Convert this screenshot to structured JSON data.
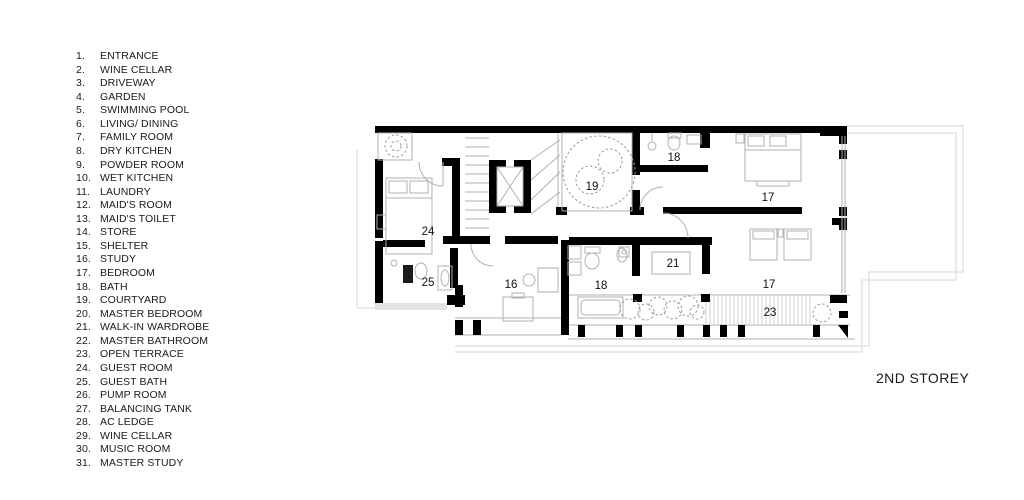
{
  "legend": {
    "items": [
      {
        "num": "1.",
        "label": "ENTRANCE"
      },
      {
        "num": "2.",
        "label": "WINE CELLAR"
      },
      {
        "num": "3.",
        "label": "DRIVEWAY"
      },
      {
        "num": "4.",
        "label": "GARDEN"
      },
      {
        "num": "5.",
        "label": "SWIMMING POOL"
      },
      {
        "num": "6.",
        "label": "LIVING/ DINING"
      },
      {
        "num": "7.",
        "label": "FAMILY ROOM"
      },
      {
        "num": "8.",
        "label": "DRY KITCHEN"
      },
      {
        "num": "9.",
        "label": "POWDER ROOM"
      },
      {
        "num": "10.",
        "label": "WET KITCHEN"
      },
      {
        "num": "11.",
        "label": "LAUNDRY"
      },
      {
        "num": "12.",
        "label": "MAID'S ROOM"
      },
      {
        "num": "13.",
        "label": "MAID'S TOILET"
      },
      {
        "num": "14.",
        "label": "STORE"
      },
      {
        "num": "15.",
        "label": "SHELTER"
      },
      {
        "num": "16.",
        "label": "STUDY"
      },
      {
        "num": "17.",
        "label": "BEDROOM"
      },
      {
        "num": "18.",
        "label": "BATH"
      },
      {
        "num": "19.",
        "label": "COURTYARD"
      },
      {
        "num": "20.",
        "label": "MASTER BEDROOM"
      },
      {
        "num": "21.",
        "label": "WALK-IN WARDROBE"
      },
      {
        "num": "22.",
        "label": "MASTER BATHROOM"
      },
      {
        "num": "23.",
        "label": "OPEN TERRACE"
      },
      {
        "num": "24.",
        "label": "GUEST ROOM"
      },
      {
        "num": "25.",
        "label": "GUEST BATH"
      },
      {
        "num": "26.",
        "label": "PUMP ROOM"
      },
      {
        "num": "27.",
        "label": "BALANCING TANK"
      },
      {
        "num": "28.",
        "label": "AC LEDGE"
      },
      {
        "num": "29.",
        "label": "WINE CELLAR"
      },
      {
        "num": "30.",
        "label": "MUSIC ROOM"
      },
      {
        "num": "31.",
        "label": "MASTER STUDY"
      }
    ]
  },
  "plan": {
    "storey_label": "2ND STOREY",
    "room_labels": {
      "courtyard": "19",
      "bath_upper": "18",
      "bedroom_upper": "17",
      "guest_room": "24",
      "guest_bath": "25",
      "study": "16",
      "bath_lower": "18",
      "walk_in_wardrobe": "21",
      "bedroom_lower": "17",
      "open_terrace": "23"
    }
  },
  "colors": {
    "wall": "#000000",
    "thin_line": "#b0b0b0",
    "outline": "#d6d6d6",
    "text": "#1a1a1a",
    "background": "#ffffff"
  }
}
